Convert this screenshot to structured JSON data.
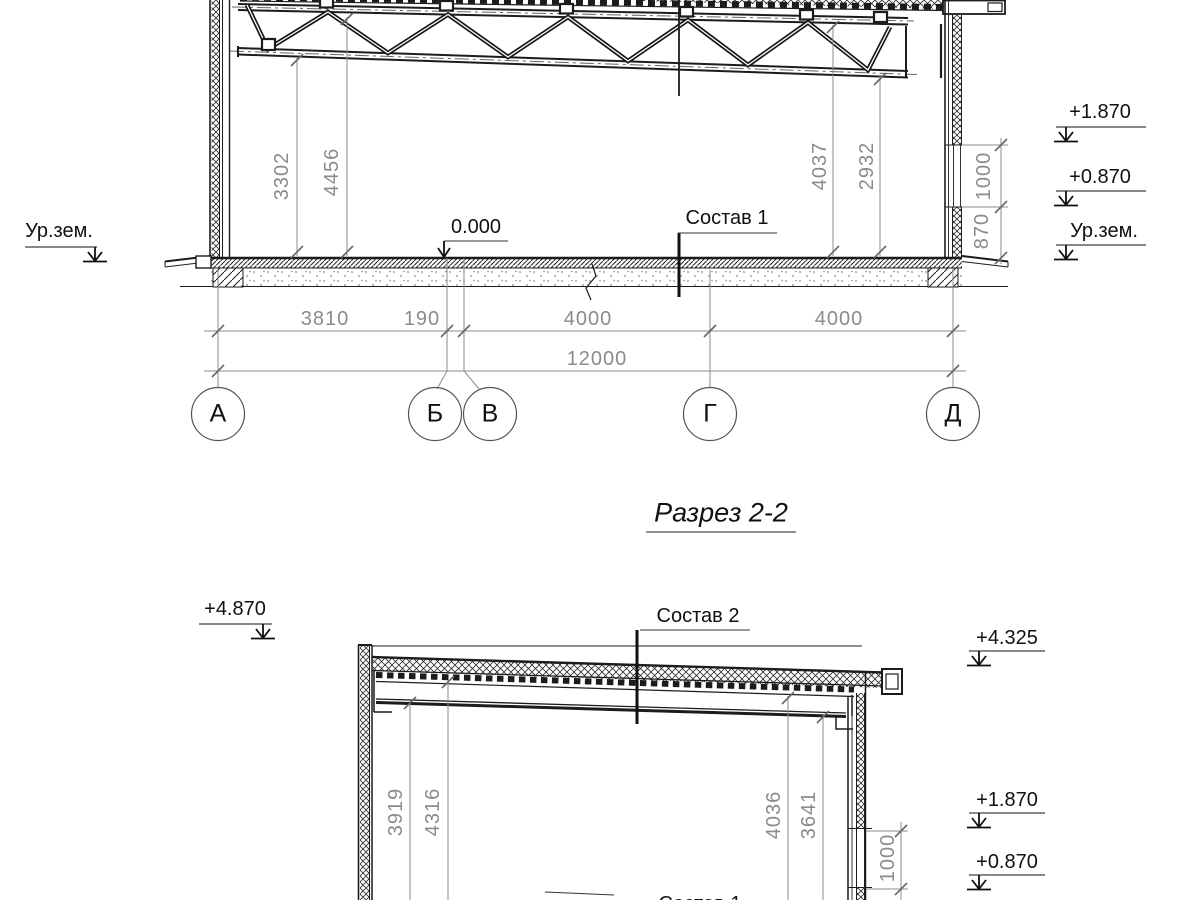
{
  "title": {
    "text": "Разрез 2-2"
  },
  "colors": {
    "ink": "#1c1c1c",
    "dim_gray": "#8b8b8b",
    "accent": "#555555"
  },
  "section1": {
    "vertical_dims": [
      "3302",
      "4456",
      "4037",
      "2932"
    ],
    "window_dims": [
      "1000",
      "870"
    ],
    "elevations_right": [
      "+1.870",
      "+0.870",
      "Ур.зем."
    ],
    "ground_label_left": "Ур.зем.",
    "floor_level": "0.000",
    "composition_label": "Состав 1",
    "horizontal_dims": [
      "3810",
      "190",
      "4000",
      "4000"
    ],
    "total_dim": "12000",
    "axes": [
      "А",
      "Б",
      "В",
      "Г",
      "Д"
    ]
  },
  "section2": {
    "elevation_top_left": "+4.870",
    "composition_label": "Состав 2",
    "elevations_right": [
      "+4.325",
      "+1.870",
      "+0.870"
    ],
    "vertical_dims": [
      "3919",
      "4316",
      "4036",
      "3641"
    ],
    "window_dim": "1000",
    "composition_label_bottom": "Состав 1"
  }
}
